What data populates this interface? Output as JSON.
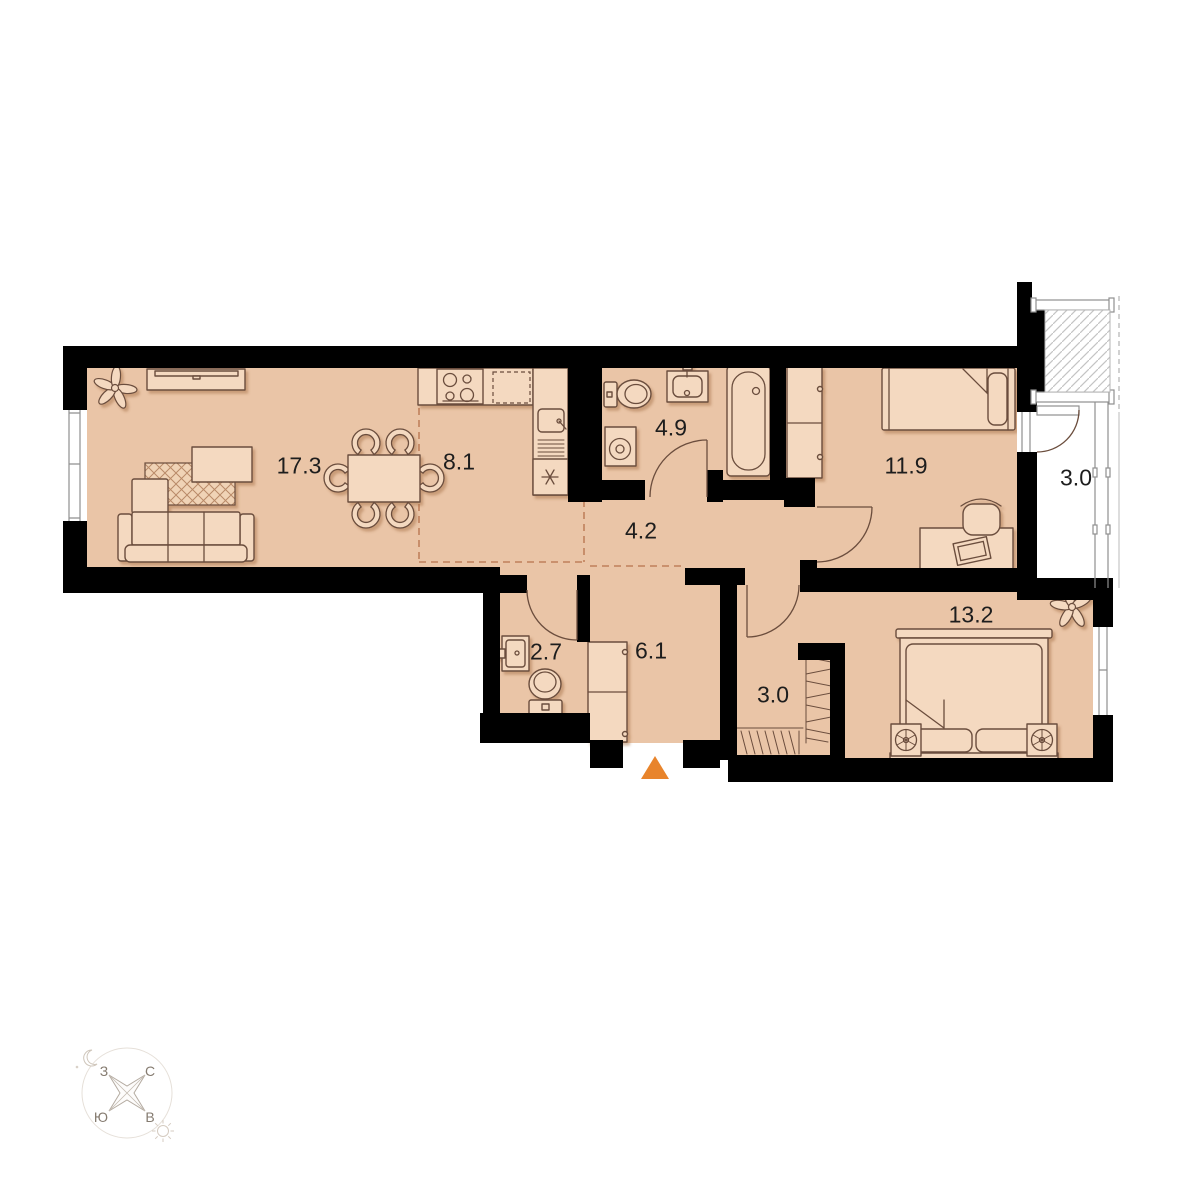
{
  "plan": {
    "rooms": {
      "living_room": {
        "area": "17.3"
      },
      "kitchen": {
        "area": "8.1"
      },
      "bathroom": {
        "area": "4.9"
      },
      "hallway": {
        "area": "4.2"
      },
      "bedroom_1": {
        "area": "11.9"
      },
      "balcony": {
        "area": "3.0"
      },
      "bedroom_2": {
        "area": "13.2"
      },
      "wc": {
        "area": "2.7"
      },
      "entry_hall": {
        "area": "6.1"
      },
      "wardrobe": {
        "area": "3.0"
      }
    },
    "colors": {
      "wall": "#000000",
      "floor": "#eac5a7",
      "furniture": "#f4d9c0",
      "outline": "#6b4d3d",
      "zone_dash": "#c0805c",
      "accent": "#e8842c",
      "hatch": "#c4c4c4"
    }
  },
  "compass": {
    "north": "С",
    "south": "Ю",
    "west": "З",
    "east": "В"
  }
}
